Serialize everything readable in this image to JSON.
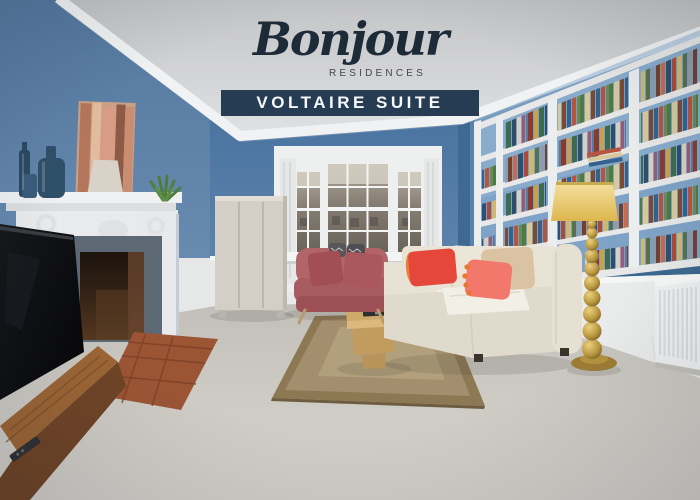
{
  "brand": {
    "script": "Bonjour",
    "tagline": "RESIDENCES"
  },
  "banner": {
    "label": "VOLTAIRE SUITE"
  },
  "colors": {
    "banner_bg": "#263c52",
    "banner_text": "#f6f7f8",
    "brand_text": "#1d2b39",
    "tagline_text": "#43474c",
    "wall_blue": "#5d83aa",
    "back_wall_blue": "#4f7aa6",
    "ceiling_gray": "#c9cacc",
    "sofa_mauve": "#b26569",
    "sofa_cream": "#e3ddd0",
    "pillow_red": "#e5483b",
    "pillow_coral": "#f2786c",
    "lamp_gold": "#b08f45",
    "lamp_shade_yellow": "#e8c76b",
    "rug_tan": "#a38f6d",
    "carpet_gray": "#cbc8c2",
    "hearth_terracotta": "#9b5535"
  },
  "scene": {
    "type": "photograph",
    "subject": "bright living room with blue walls, bay window, fireplace and built-in bookshelves",
    "elements": [
      "ceiling-crown-molding",
      "blue-walls",
      "bay-window",
      "white-wardrobe",
      "white-fireplace-mantel",
      "street-art-canvas",
      "blue-glass-bottles",
      "potted-plant",
      "built-in-bookshelves",
      "books",
      "radiator",
      "white-wainscoting",
      "beige-carpet",
      "bordered-area-rug",
      "wooden-coffee-table",
      "remote-control",
      "mauve-loveseat",
      "cream-sectional-sofa",
      "red-coral-cushions",
      "gold-stacked-ball-floor-lamp",
      "yellow-lamp-shade",
      "flat-screen-tv",
      "wooden-media-bench",
      "terracotta-hearth-tiles"
    ]
  }
}
